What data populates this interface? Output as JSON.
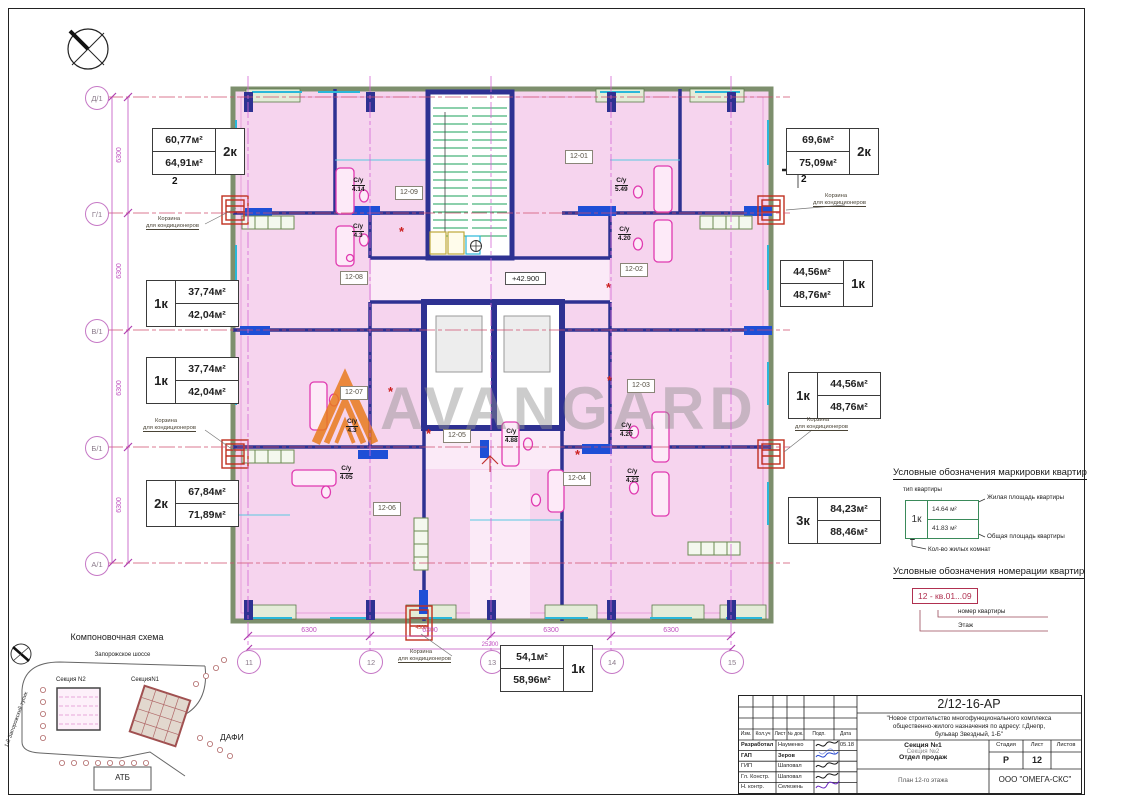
{
  "watermark": "AVANGARD",
  "level_mark": "+42.900",
  "colors": {
    "room_pink": "#f6d4ee",
    "wall_navy": "#2e3192",
    "grid_magenta": "#d466d4",
    "annotation_red": "#c03020",
    "logo_orange": "#e87b1e",
    "column_blue": "#1e4fd6"
  },
  "axes": {
    "rows": [
      "Д/1",
      "Г/1",
      "В/1",
      "Б/1",
      "А/1"
    ],
    "cols": [
      "11",
      "12",
      "13",
      "14",
      "15"
    ],
    "seg": "6300",
    "total": "25200",
    "extra": "4500"
  },
  "tags": [
    "12-01",
    "12-02",
    "12-03",
    "12-04",
    "12-05",
    "12-06",
    "12-07",
    "12-08",
    "12-09"
  ],
  "wc": {
    "label": "С/у",
    "values": [
      "4.14",
      "5.49",
      "4.3",
      "4.20",
      "4.3",
      "4.05",
      "4.88",
      "4.20",
      "4.23"
    ]
  },
  "areas": [
    {
      "type": "2к",
      "living": "60,77м²",
      "total": "64,91м²"
    },
    {
      "type": "2к",
      "living": "69,6м²",
      "total": "75,09м²"
    },
    {
      "type": "1к",
      "living": "44,56м²",
      "total": "48,76м²"
    },
    {
      "type": "1к",
      "living": "37,74м²",
      "total": "42,04м²"
    },
    {
      "type": "1к",
      "living": "37,74м²",
      "total": "42,04м²"
    },
    {
      "type": "1к",
      "living": "44,56м²",
      "total": "48,76м²"
    },
    {
      "type": "2к",
      "living": "67,84м²",
      "total": "71,89м²"
    },
    {
      "type": "3к",
      "living": "84,23м²",
      "total": "88,46м²"
    },
    {
      "type": "1к",
      "living": "54,1м²",
      "total": "58,96м²"
    }
  ],
  "basket": {
    "l1": "Корзина",
    "l2": "для кондиционеров"
  },
  "section_mark": "2",
  "legend1": {
    "title": "Условные обозначения маркировки квартир",
    "type_label": "тип квартиры",
    "sample_type": "1к",
    "living": "14.64 м²",
    "total": "41.83 м²",
    "living_label": "Жилая площадь квартиры",
    "total_label": "Общая площадь квартиры",
    "rooms_label": "Кол-во жилых комнат"
  },
  "legend2": {
    "title": "Условные обозначения номерации квартир",
    "sample": "12 - кв.01...09",
    "apt_label": "номер квартиры",
    "floor_label": "Этаж"
  },
  "site": {
    "title": "Компоновочная схема",
    "road": "Запорожское шоссе",
    "s2": "Секция N2",
    "s1": "СекцияN1",
    "street": "1-й Запорожский тупик",
    "dafi": "ДАФИ",
    "atb": "АТБ"
  },
  "tb": {
    "code": "2/12-16-АР",
    "desc1": "\"Новое строительство многофункционального комплекса",
    "desc2": "общественно-жилого назначения по адресу: г.Днепр,",
    "desc3": "бульвар Звездный, 1-Б\"",
    "cols": [
      "Изм.",
      "Кол.уч",
      "Лист",
      "№ док.",
      "Подп.",
      "Дата"
    ],
    "rows": [
      {
        "role": "Разработал",
        "name": "Науменко",
        "date": "05.18"
      },
      {
        "role": "ГАП",
        "name": "Зеров",
        "date": ""
      },
      {
        "role": "ГИП",
        "name": "Шаповал",
        "date": ""
      },
      {
        "role": "Гл. Констр.",
        "name": "Шаповал",
        "date": ""
      },
      {
        "role": "Н. контр.",
        "name": "Селезень",
        "date": ""
      }
    ],
    "sec1": "Секция №1",
    "sec2": "Секция №2",
    "sec3": "Отдел продаж",
    "stage_h": "Стадия",
    "sheet_h": "Лист",
    "sheets_h": "Листов",
    "stage": "Р",
    "sheet": "12",
    "sheets": "",
    "title": "План 12-го этажа",
    "company": "ООО \"ОМЕГА-СКС\""
  }
}
